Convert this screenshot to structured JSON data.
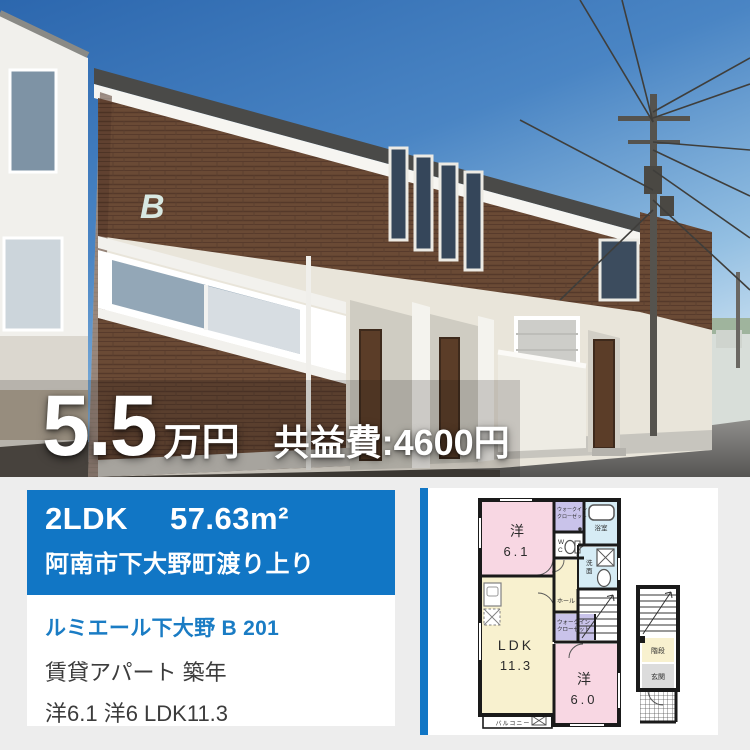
{
  "colors": {
    "accent_blue": "#1176c5",
    "link_blue": "#1a7cc4",
    "text_dark": "#3c3c3c",
    "page_bg": "#ededed",
    "plan_pink": "#f8d7e3",
    "plan_cream": "#f8f1cf",
    "plan_lavender": "#c9c3ea",
    "plan_lightblue": "#d6ecf5"
  },
  "photo": {
    "emblem_letter": "B"
  },
  "price_overlay": {
    "amount": "5.5",
    "unit": "万円",
    "common_fee": "共益費:4600円"
  },
  "summary_card": {
    "layout": "2LDK",
    "area": "57.63m²",
    "address": "阿南市下大野町渡り上り",
    "property_name": "ルミエール下大野 B 201",
    "property_type": "賃貸アパート 築年",
    "room_breakdown": "洋6.1 洋6 LDK11.3"
  },
  "floorplan": {
    "bedroom1_label": "洋",
    "bedroom1_size": "6.1",
    "bedroom2_label": "洋",
    "bedroom2_size": "6.0",
    "ldk_label": "LDK",
    "ldk_size": "11.3",
    "wic_line1": "ウォークイン",
    "wic_line2": "クローゼット",
    "wc_line1": "W",
    "wc_line2": "C",
    "bath": "浴室",
    "wash_line1": "洗",
    "wash_line2": "面",
    "hall": "ホール",
    "stairs": "階段",
    "entrance": "玄関",
    "balcony": "バルコニー"
  }
}
